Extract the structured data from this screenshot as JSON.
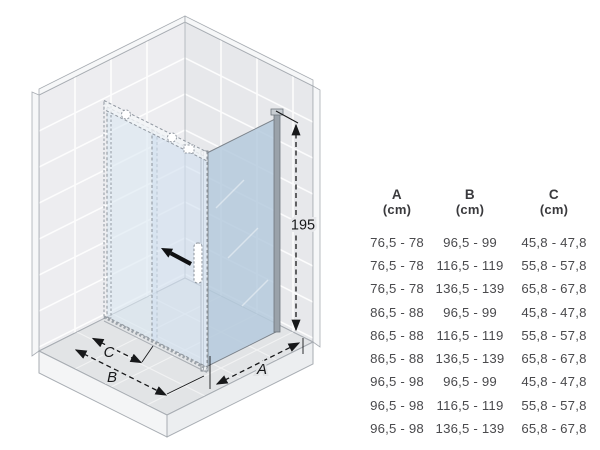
{
  "diagram": {
    "height_label": "195",
    "dim_a_label": "A",
    "dim_b_label": "B",
    "dim_c_label": "C"
  },
  "icons": {
    "slide_direction": "arrow-up-left"
  },
  "table": {
    "columns": [
      {
        "letter": "A",
        "unit": "(cm)"
      },
      {
        "letter": "B",
        "unit": "(cm)"
      },
      {
        "letter": "C",
        "unit": "(cm)"
      }
    ],
    "rows": [
      [
        "76,5 - 78",
        "96,5 - 99",
        "45,8 - 47,8"
      ],
      [
        "76,5 - 78",
        "116,5 - 119",
        "55,8 - 57,8"
      ],
      [
        "76,5 - 78",
        "136,5 - 139",
        "65,8 - 67,8"
      ],
      [
        "86,5 - 88",
        "96,5 - 99",
        "45,8 - 47,8"
      ],
      [
        "86,5 - 88",
        "116,5 - 119",
        "55,8 - 57,8"
      ],
      [
        "86,5 - 88",
        "136,5 - 139",
        "65,8 - 67,8"
      ],
      [
        "96,5 - 98",
        "96,5 - 99",
        "45,8 - 47,8"
      ],
      [
        "96,5 - 98",
        "116,5 - 119",
        "55,8 - 57,8"
      ],
      [
        "96,5 - 98",
        "136,5 - 139",
        "65,8 - 67,8"
      ]
    ]
  },
  "colors": {
    "wall_tile": "#ededf0",
    "wall_tile_right": "#e7e8eb",
    "floor": "#e2e4e6",
    "glass_door": "#d9e6f2",
    "glass_fixed_panel": "#b5cadd",
    "profile_gray": "#9aa2aa",
    "dimension_line": "#17181a",
    "table_text": "#4a4a4d"
  }
}
